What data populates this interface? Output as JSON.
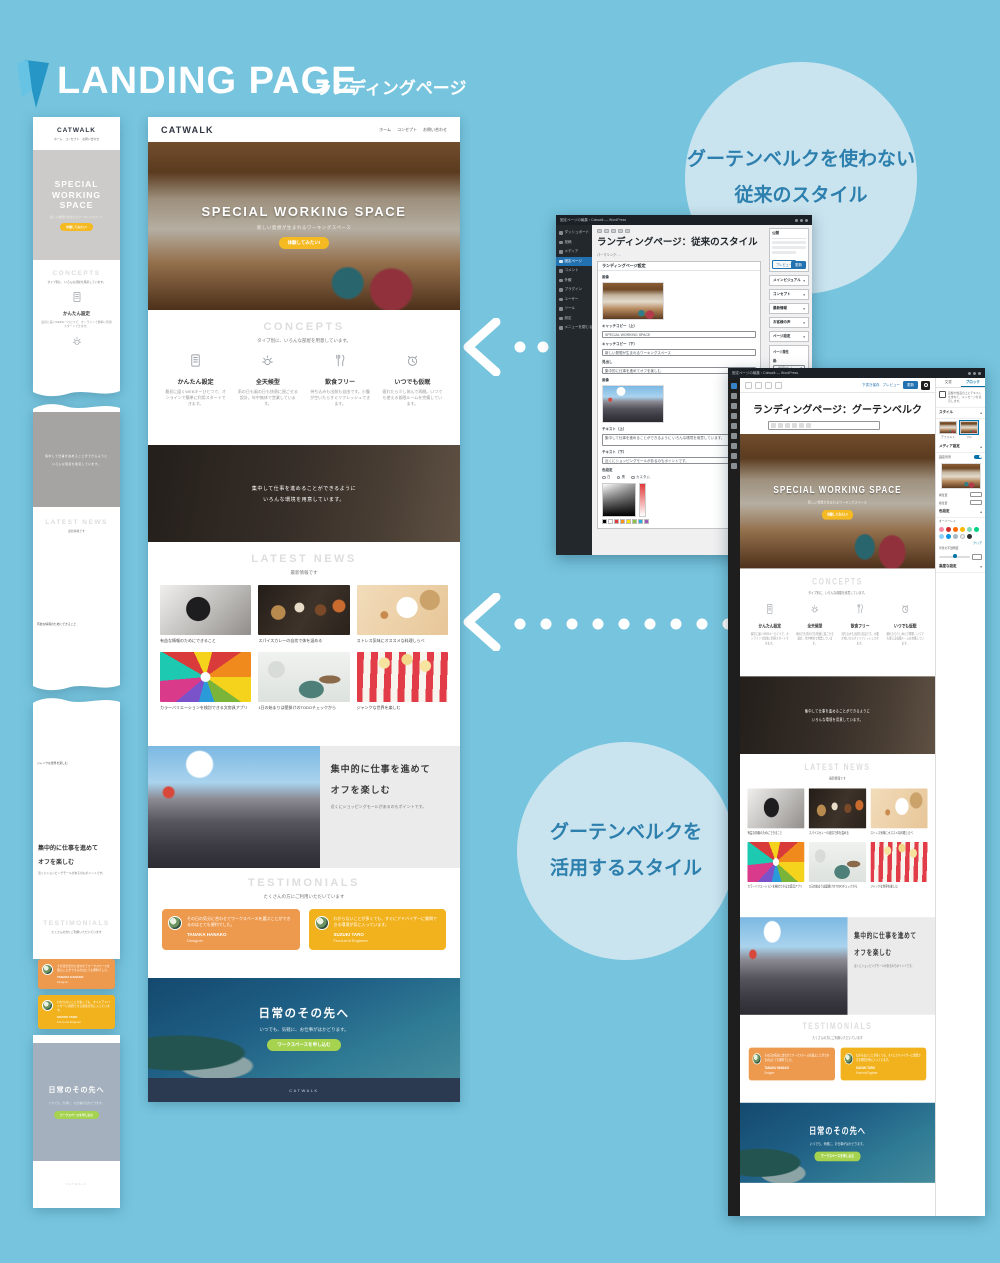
{
  "colors": {
    "background": "#76c4de",
    "bubble": "#c9e4ef",
    "bubble_text": "#2d7fad",
    "logo_blue": "#2596c6",
    "accent_yellow": "#f5b921",
    "card_orange": "#ee9a4e",
    "card_yellow": "#f2b21e",
    "button_lime": "#a6d34f",
    "footer_navy": "#2b3951",
    "wp_blue": "#2271b1"
  },
  "page": {
    "title": "LANDING PAGE",
    "subtitle": "ランディングページ"
  },
  "callouts": {
    "classic_line1": "グーテンベルクを使わない",
    "classic_line2": "従来のスタイル",
    "gutenberg_line1": "グーテンベルクを",
    "gutenberg_line2": "活用するスタイル"
  },
  "site": {
    "brand": "CATWALK",
    "nav": [
      "ホーム",
      "コンセプト",
      "お問い合わせ"
    ],
    "hero": {
      "title": "SPECIAL WORKING SPACE",
      "subtitle": "新しい発想が生まれるワーキングスペース",
      "button": "体験してみたい!"
    },
    "concepts": {
      "heading": "CONCEPTS",
      "lead": "タイプ別に、いろんな部屋を用意しています。",
      "items": [
        {
          "icon": "document-icon",
          "title": "かんたん設定",
          "desc": "最初に届くWEBキーひとつで、オンラインで簡単に利用スタートできます。"
        },
        {
          "icon": "weather-icon",
          "title": "全天候型",
          "desc": "雨の日も風の日も快適に過ごせる設計。年中無休で営業しています。"
        },
        {
          "icon": "cutlery-icon",
          "title": "飲食フリー",
          "desc": "持ち込みも出前も自由です。小腹が空いたらすぐリフレッシュできます。"
        },
        {
          "icon": "alarm-clock-icon",
          "title": "いつでも仮眠",
          "desc": "疲れたら少し休んで再開。いつでも使える仮眠ルームを完備しています。"
        }
      ]
    },
    "midbanner": {
      "line1": "集中して仕事を進めることができるように",
      "line2": "いろんな環境を用意しています。"
    },
    "news": {
      "heading": "LATEST NEWS",
      "lead": "最新情報です",
      "items": [
        {
          "caption": "有益な情報のためにできること"
        },
        {
          "caption": "スパイスカレーの自炊で体を温める"
        },
        {
          "caption": "ストレス気味にオススメな料理しらべ"
        },
        {
          "caption": "カラーバリエーションを検討できる文房具アプリ"
        },
        {
          "caption": "1日の始まりは壁掛けのTODOチェックから"
        },
        {
          "caption": "ジャンクな世界を楽しむ"
        }
      ]
    },
    "feature": {
      "line1": "集中的に仕事を進めて",
      "line2": "オフを楽しむ",
      "desc": "近くにショッピングモールがあるのもポイントです。"
    },
    "testimonials": {
      "heading": "TESTIMONIALS",
      "lead": "たくさんの方にご利用いただいています",
      "cards": [
        {
          "text": "その日の気分に合わせてワークスペースを選ぶことができるのはとても便利でした。",
          "name": "TANAKA HANAKO",
          "role": "Designer"
        },
        {
          "text": "わからないことが多くても、すぐにアドバイザーに質問できる環境が気に入っています。",
          "name": "SUZUKI TARO",
          "role": "Front-end Engineer"
        }
      ]
    },
    "cta": {
      "heading": "日常のその先へ",
      "text": "いつでも、気軽に、お仕事がはかどります。",
      "button": "ワークスペースを申し込む"
    },
    "footer": "CATWALK"
  },
  "classic_editor": {
    "window_title": "固定ページの編集 ‹ Catwalk — WordPress",
    "admin_menu": [
      "ダッシュボード",
      "投稿",
      "メディア",
      "固定ページ",
      "コメント",
      "外観",
      "プラグイン",
      "ユーザー",
      "ツール",
      "設定",
      "メニューを閉じる"
    ],
    "page_title": "ランディングページ：従来のスタイル",
    "permalink_label": "パーマリンク:",
    "metabox_title": "ランディングページ設定",
    "fields": [
      {
        "label": "画像"
      },
      {
        "label": "キャッチコピー（上）",
        "value": "SPECIAL WORKING SPACE"
      },
      {
        "label": "キャッチコピー（下）",
        "value": "新しい発想が生まれるワーキングスペース"
      },
      {
        "label": "ボタン",
        "value": "体験してみたい!"
      },
      {
        "label": "見出し",
        "value": "集中的に仕事を進めてオフを楽しむ"
      },
      {
        "label": "画像"
      },
      {
        "label": "テキスト（上）",
        "value": "集中して仕事を進めることができるように いろんな環境を用意しています。"
      },
      {
        "label": "テキスト（下）",
        "value": "近くにショッピングモールがあるのもポイントです。"
      },
      {
        "label": "色設定"
      }
    ],
    "color_options": [
      "白",
      "黒",
      "カスタム"
    ],
    "publish": {
      "tab": "公開",
      "preview": "プレビュー",
      "update": "更新"
    },
    "side_panels": [
      "メインビジュアル",
      "コンセプト",
      "最新情報",
      "お客様の声",
      "ページ設定"
    ],
    "attributes": {
      "title": "ページ属性",
      "parent_label": "親:",
      "parent_value": "（指定なし）",
      "template_label": "テンプレート:",
      "template_value": "ランディングページ"
    }
  },
  "gutenberg_editor": {
    "window_title": "固定ページの編集 ‹ Catwalk — WordPress",
    "page_title": "ランディングページ：グーテンベルク",
    "topbar": {
      "save": "下書き保存",
      "preview": "プレビュー",
      "update": "更新"
    },
    "tabs": {
      "document": "文書",
      "block": "ブロック"
    },
    "block": {
      "name": "カバー",
      "desc": "画像や動画の上にテキストを重ねて、メッセージを表示します。"
    },
    "panels": {
      "styles": "スタイル",
      "style_default": "デフォルト",
      "style_full": "フル",
      "media": "メディア設定",
      "fixed_bg": "固定背景",
      "focal_x": "横位置",
      "focal_y": "縦位置",
      "color": "色設定",
      "overlay": "オーバーレイ",
      "clear": "クリア",
      "opacity": "背景の不透明度",
      "advanced": "高度な設定"
    },
    "palette": [
      "#f78da7",
      "#cf2e2e",
      "#ff6900",
      "#fcb900",
      "#7bdcb5",
      "#00d084",
      "#8ed1fc",
      "#0693e3",
      "#abb8c3",
      "#eeeeee",
      "#313131"
    ]
  }
}
